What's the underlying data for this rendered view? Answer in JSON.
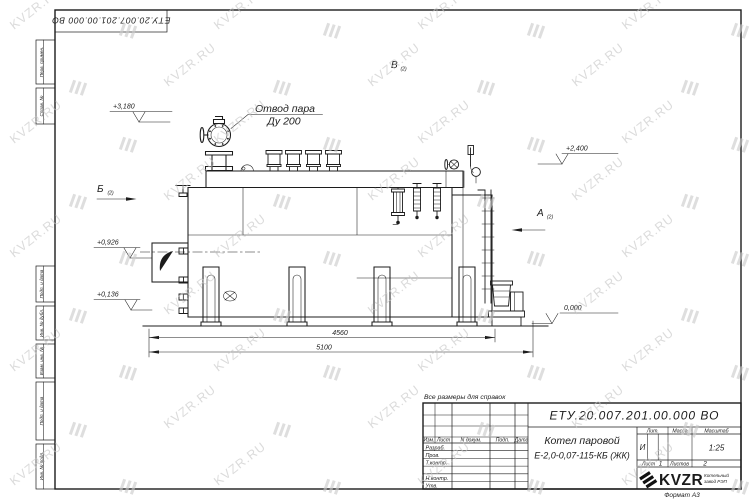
{
  "watermark": {
    "text": "KVZR.RU"
  },
  "frame": {
    "doc_number_top": "ЕТУ.20.007.201.00.000  ВО",
    "format_note": "Формат А3"
  },
  "margin": {
    "labels": [
      "Перв. примен.",
      "Справ. №",
      "Подп. и дата",
      "Инв. № дубл.",
      "Взам. инв. №",
      "Подп. и дата",
      "Инв. № подл."
    ]
  },
  "drawing": {
    "note": "Все размеры для справок",
    "callout": {
      "line1": "Отвод пара",
      "line2": "Ду 200"
    },
    "views": [
      {
        "letter": "Б",
        "ref": "(2)"
      },
      {
        "letter": "В",
        "ref": "(2)"
      },
      {
        "letter": "А",
        "ref": "(2)"
      }
    ],
    "elevations": [
      {
        "value": "+3,180"
      },
      {
        "value": "+2,400"
      },
      {
        "value": "+0,926"
      },
      {
        "value": "+0,136"
      },
      {
        "value": "0,000"
      }
    ],
    "dimensions": [
      {
        "value": "4560"
      },
      {
        "value": "5100"
      }
    ]
  },
  "title_block": {
    "doc_number": "ЕТУ.20.007.201.00.000  ВО",
    "product_name_line1": "Котел паровой",
    "product_name_line2": "Е-2,0-0,07-115-КБ (ЖК)",
    "columns": {
      "izm": "Изм.",
      "list": "Лист",
      "n_dokum": "N докум.",
      "podp": "Подп.",
      "data": "Дата"
    },
    "roles": {
      "razrab": "Разраб.",
      "prov": "Пров.",
      "tkontr": "Т.контр.",
      "nkontr": "Н.контр.",
      "utv": "Утв."
    },
    "lit_label": "Лит.",
    "massa_label": "Масса",
    "masshtab_label": "Масштаб",
    "lit_value": "И",
    "masshtab_value": "1:25",
    "sheet_label": "Лист",
    "sheet_value": "1",
    "sheets_label": "Листов",
    "sheets_value": "2",
    "company": {
      "logo_text": "KVZR",
      "tagline_line1": "Котельный",
      "tagline_line2": "завод РЭП"
    }
  }
}
